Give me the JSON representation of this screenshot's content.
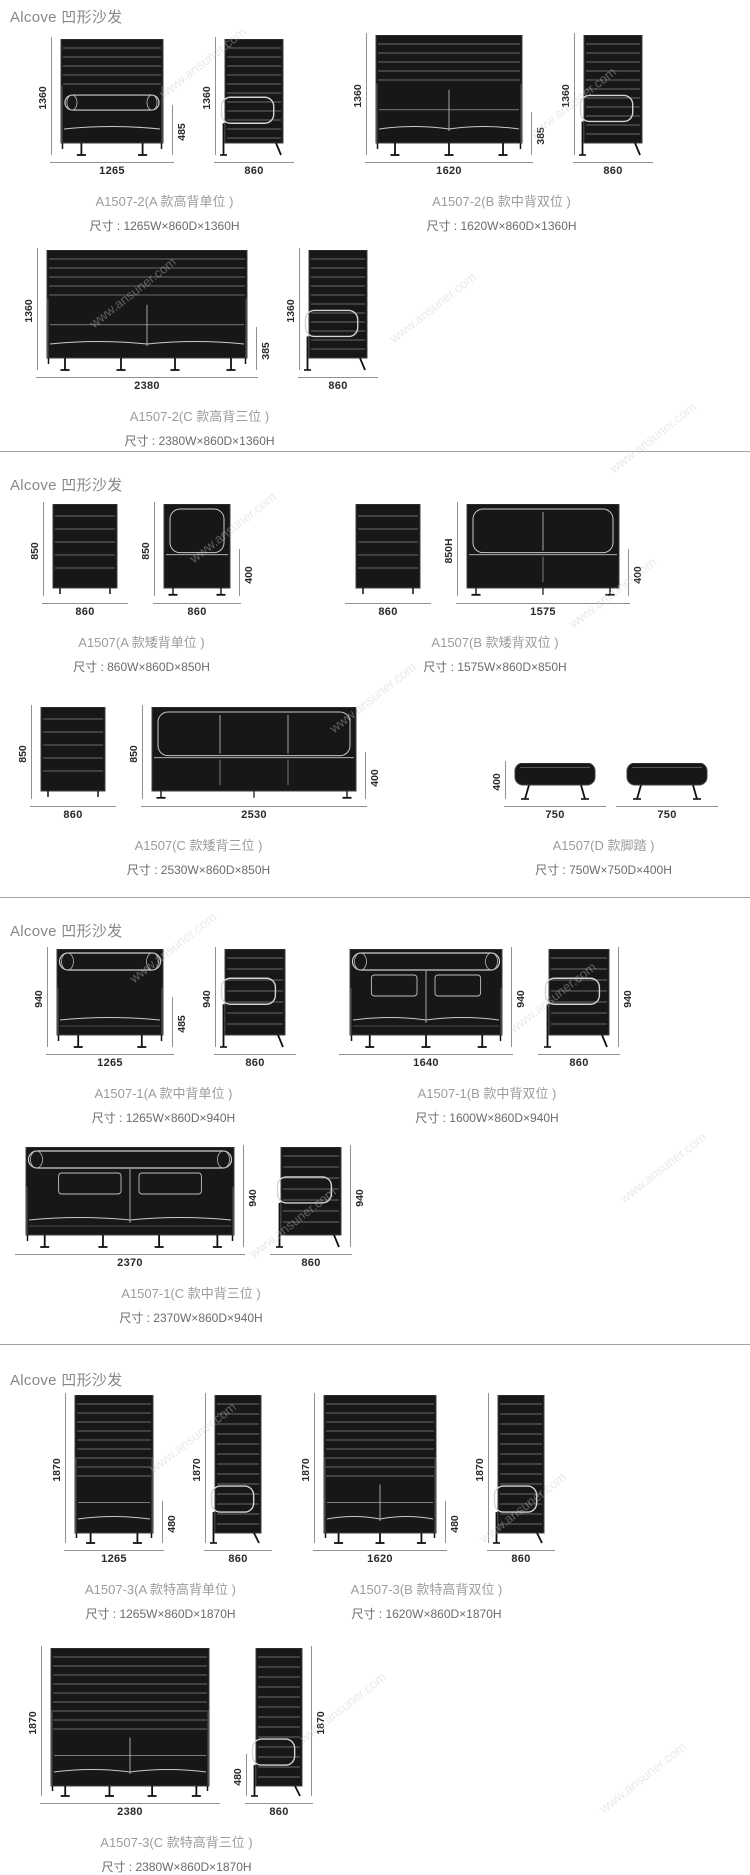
{
  "watermark": {
    "text": "www.ansuner.com"
  },
  "sections": [
    {
      "header": "Alcove 凹形沙发",
      "rows": [
        {
          "groups": [
            {
              "title": "A1507-2(A 款高背单位 )",
              "size": "尺寸 : 1265W×860D×1360H",
              "views": [
                {
                  "type": "front",
                  "draw": {
                    "kind": "hb-front",
                    "w": 102,
                    "bh": 104,
                    "lh": 12,
                    "sf": 0.52,
                    "bolster": true,
                    "legs": 2
                  },
                  "dims": {
                    "left": {
                      "label": "1360",
                      "frac": 1
                    },
                    "right": {
                      "label": "485",
                      "frac": 0.42
                    },
                    "bottom": "1265"
                  }
                },
                {
                  "type": "side",
                  "draw": {
                    "kind": "side",
                    "w": 58,
                    "bh": 104,
                    "lh": 12,
                    "armFrac": 0.56,
                    "step": 9
                  },
                  "dims": {
                    "left": {
                      "label": "1360",
                      "frac": 1
                    },
                    "bottom": "860"
                  }
                }
              ]
            },
            {
              "title": "A1507-2(B 款中背双位 )",
              "size": "尺寸 : 1620W×860D×1360H",
              "views": [
                {
                  "type": "front",
                  "draw": {
                    "kind": "hb-front",
                    "w": 146,
                    "bh": 108,
                    "lh": 12,
                    "sf": 0.47,
                    "divs": 1,
                    "legs": 3
                  },
                  "dims": {
                    "left": {
                      "label": "1360",
                      "frac": 1
                    },
                    "right": {
                      "label": "385",
                      "frac": 0.35
                    },
                    "bottom": "1620"
                  }
                },
                {
                  "type": "side",
                  "draw": {
                    "kind": "side",
                    "w": 58,
                    "bh": 108,
                    "lh": 12,
                    "armFrac": 0.56,
                    "step": 9
                  },
                  "dims": {
                    "left": {
                      "label": "1360",
                      "frac": 1
                    },
                    "bottom": "860"
                  }
                }
              ]
            }
          ]
        },
        {
          "groups": [
            {
              "title": "A1507-2(C 款高背三位 )",
              "size": "尺寸 : 2380W×860D×1360H",
              "views": [
                {
                  "type": "front",
                  "draw": {
                    "kind": "hb-front",
                    "w": 200,
                    "bh": 108,
                    "lh": 12,
                    "sf": 0.47,
                    "divs": 1,
                    "legs": 4
                  },
                  "dims": {
                    "left": {
                      "label": "1360",
                      "frac": 1
                    },
                    "right": {
                      "label": "385",
                      "frac": 0.35
                    },
                    "bottom": "2380"
                  }
                },
                {
                  "type": "side",
                  "draw": {
                    "kind": "side",
                    "w": 58,
                    "bh": 108,
                    "lh": 12,
                    "armFrac": 0.56,
                    "step": 9
                  },
                  "dims": {
                    "left": {
                      "label": "1360",
                      "frac": 1
                    },
                    "bottom": "860"
                  }
                }
              ]
            }
          ]
        }
      ]
    },
    {
      "header": "Alcove 凹形沙发",
      "rows": [
        {
          "groups": [
            {
              "title": "A1507(A 款矮背单位 )",
              "size": "尺寸 : 860W×860D×850H",
              "views": [
                {
                  "type": "back",
                  "draw": {
                    "kind": "back",
                    "w": 64,
                    "bh": 84,
                    "lh": 8
                  },
                  "dims": {
                    "left": {
                      "label": "850",
                      "frac": 1
                    },
                    "bottom": "860"
                  }
                },
                {
                  "type": "front",
                  "draw": {
                    "kind": "lb-front",
                    "w": 66,
                    "bh": 84,
                    "lh": 8,
                    "archs": 1
                  },
                  "dims": {
                    "left": {
                      "label": "850",
                      "frac": 1
                    },
                    "right": {
                      "label": "400",
                      "frac": 0.5
                    },
                    "bottom": "860"
                  }
                }
              ]
            },
            {
              "title": "A1507(B 款矮背双位 )",
              "size": "尺寸 : 1575W×860D×850H",
              "views": [
                {
                  "type": "back",
                  "draw": {
                    "kind": "back",
                    "w": 64,
                    "bh": 84,
                    "lh": 8
                  },
                  "dims": {
                    "bottom": "860"
                  }
                },
                {
                  "type": "front",
                  "draw": {
                    "kind": "lb-front",
                    "w": 152,
                    "bh": 84,
                    "lh": 8,
                    "archs": 2,
                    "divs": 1
                  },
                  "dims": {
                    "left": {
                      "label": "850H",
                      "frac": 1
                    },
                    "right": {
                      "label": "400",
                      "frac": 0.5
                    },
                    "bottom": "1575"
                  }
                }
              ]
            }
          ]
        },
        {
          "groups": [
            {
              "title": "A1507(C 款矮背三位 )",
              "size": "尺寸 : 2530W×860D×850H",
              "views": [
                {
                  "type": "back",
                  "draw": {
                    "kind": "back",
                    "w": 64,
                    "bh": 84,
                    "lh": 8
                  },
                  "dims": {
                    "left": {
                      "label": "850",
                      "frac": 1
                    },
                    "bottom": "860"
                  }
                },
                {
                  "type": "front",
                  "draw": {
                    "kind": "lb-front",
                    "w": 204,
                    "bh": 84,
                    "lh": 8,
                    "archs": 3,
                    "divs": 2
                  },
                  "dims": {
                    "left": {
                      "label": "850",
                      "frac": 1
                    },
                    "right": {
                      "label": "400",
                      "frac": 0.5
                    },
                    "bottom": "2530"
                  }
                }
              ]
            },
            {
              "title": "A1507(D 款脚踏 )",
              "size": "尺寸 : 750W×750D×400H",
              "views": [
                {
                  "type": "ottoman",
                  "draw": {
                    "kind": "ottoman",
                    "w": 80,
                    "bh": 22,
                    "lh": 14
                  },
                  "dims": {
                    "left": {
                      "label": "400",
                      "frac": 1
                    },
                    "bottom": "750"
                  }
                },
                {
                  "type": "ottoman",
                  "draw": {
                    "kind": "ottoman",
                    "w": 80,
                    "bh": 22,
                    "lh": 14
                  },
                  "dims": {
                    "bottom": "750"
                  }
                }
              ]
            }
          ]
        }
      ]
    },
    {
      "header": "Alcove 凹形沙发",
      "rows": [
        {
          "groups": [
            {
              "title": "A1507-1(A 款中背单位 )",
              "size": "尺寸 : 1265W×860D×940H",
              "views": [
                {
                  "type": "front",
                  "draw": {
                    "kind": "mb-front",
                    "w": 106,
                    "bh": 86,
                    "lh": 12,
                    "pillows": 0,
                    "legs": 2
                  },
                  "dims": {
                    "left": {
                      "label": "940",
                      "frac": 1
                    },
                    "right": {
                      "label": "485",
                      "frac": 0.5
                    },
                    "bottom": "1265"
                  }
                },
                {
                  "type": "side",
                  "draw": {
                    "kind": "side",
                    "w": 60,
                    "bh": 86,
                    "lh": 12,
                    "armFrac": 0.34,
                    "step": 11
                  },
                  "dims": {
                    "left": {
                      "label": "940",
                      "frac": 1
                    },
                    "bottom": "860"
                  }
                }
              ]
            },
            {
              "title": "A1507-1(B 款中背双位 )",
              "size": "尺寸 : 1600W×860D×940H",
              "views": [
                {
                  "type": "front",
                  "draw": {
                    "kind": "mb-front",
                    "w": 152,
                    "bh": 86,
                    "lh": 12,
                    "pillows": 2,
                    "divs": 1,
                    "legs": 3
                  },
                  "dims": {
                    "right": {
                      "label": "940",
                      "frac": 1
                    },
                    "bottom": "1640"
                  }
                },
                {
                  "type": "side",
                  "draw": {
                    "kind": "side",
                    "w": 60,
                    "bh": 86,
                    "lh": 12,
                    "armFrac": 0.34,
                    "step": 11
                  },
                  "dims": {
                    "right": {
                      "label": "940",
                      "frac": 1
                    },
                    "bottom": "860"
                  }
                }
              ]
            }
          ]
        },
        {
          "groups": [
            {
              "title": "A1507-1(C 款中背三位 )",
              "size": "尺寸 : 2370W×860D×940H",
              "views": [
                {
                  "type": "front",
                  "draw": {
                    "kind": "mb-front",
                    "w": 208,
                    "bh": 88,
                    "lh": 12,
                    "pillows": 2,
                    "divs": 1,
                    "legs": 4
                  },
                  "dims": {
                    "right": {
                      "label": "940",
                      "frac": 1
                    },
                    "bottom": "2370"
                  }
                },
                {
                  "type": "side",
                  "draw": {
                    "kind": "side",
                    "w": 60,
                    "bh": 88,
                    "lh": 12,
                    "armFrac": 0.34,
                    "step": 11
                  },
                  "dims": {
                    "right": {
                      "label": "940",
                      "frac": 1
                    },
                    "bottom": "860"
                  }
                }
              ]
            }
          ]
        }
      ]
    },
    {
      "header": "Alcove 凹形沙发",
      "rows": [
        {
          "groups": [
            {
              "title": "A1507-3(A 款特高背单位 )",
              "size": "尺寸 : 1265W×860D×1870H",
              "views": [
                {
                  "type": "front",
                  "draw": {
                    "kind": "hb-front",
                    "w": 78,
                    "bh": 138,
                    "lh": 10,
                    "sf": 0.62,
                    "legs": 2
                  },
                  "dims": {
                    "left": {
                      "label": "1870",
                      "frac": 1
                    },
                    "right": {
                      "label": "480",
                      "frac": 0.28
                    },
                    "bottom": "1265"
                  }
                },
                {
                  "type": "side",
                  "draw": {
                    "kind": "side",
                    "w": 46,
                    "bh": 138,
                    "lh": 10,
                    "armFrac": 0.66,
                    "step": 10
                  },
                  "dims": {
                    "left": {
                      "label": "1870",
                      "frac": 1
                    },
                    "bottom": "860"
                  }
                }
              ]
            },
            {
              "title": "A1507-3(B 款特高背双位 )",
              "size": "尺寸 : 1620W×860D×1870H",
              "views": [
                {
                  "type": "front",
                  "draw": {
                    "kind": "hb-front",
                    "w": 112,
                    "bh": 138,
                    "lh": 10,
                    "sf": 0.62,
                    "divs": 1,
                    "legs": 3
                  },
                  "dims": {
                    "left": {
                      "label": "1870",
                      "frac": 1
                    },
                    "right": {
                      "label": "480",
                      "frac": 0.28
                    },
                    "bottom": "1620"
                  }
                },
                {
                  "type": "side",
                  "draw": {
                    "kind": "side",
                    "w": 46,
                    "bh": 138,
                    "lh": 10,
                    "armFrac": 0.66,
                    "step": 10
                  },
                  "dims": {
                    "left": {
                      "label": "1870",
                      "frac": 1
                    },
                    "bottom": "860"
                  }
                }
              ]
            }
          ]
        },
        {
          "groups": [
            {
              "title": "A1507-3(C 款特高背三位 )",
              "size": "尺寸 : 2380W×860D×1870H",
              "views": [
                {
                  "type": "front",
                  "draw": {
                    "kind": "hb-front",
                    "w": 158,
                    "bh": 138,
                    "lh": 10,
                    "sf": 0.62,
                    "divs": 1,
                    "legs": 4
                  },
                  "dims": {
                    "left": {
                      "label": "1870",
                      "frac": 1
                    },
                    "bottom": "2380"
                  }
                },
                {
                  "type": "side",
                  "draw": {
                    "kind": "side",
                    "w": 46,
                    "bh": 138,
                    "lh": 10,
                    "armFrac": 0.66,
                    "step": 10
                  },
                  "dims": {
                    "left": {
                      "label": "480",
                      "frac": 0.28
                    },
                    "right": {
                      "label": "1870",
                      "frac": 1
                    },
                    "bottom": "860"
                  }
                }
              ]
            }
          ]
        }
      ]
    }
  ]
}
